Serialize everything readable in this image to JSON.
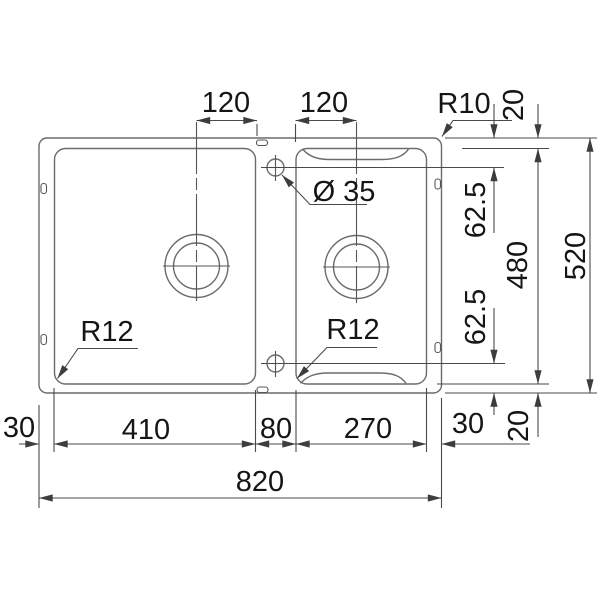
{
  "drawing": {
    "description": "Technical top-view dimension drawing of a one-and-a-half bowl kitchen sink",
    "background": "#ffffff",
    "line_color": "#6b6b6b",
    "dimension_line_color": "#4a4a4a",
    "text_color": "#151515"
  },
  "labels": {
    "top_offset_left_bowl": "120",
    "top_offset_right_bowl": "120",
    "outer_corner_radius": "R10",
    "rim_top": "20",
    "tap_hole_diameter": "Ø 35",
    "hole_offset_top": "62.5",
    "inner_height": "480",
    "overall_height": "520",
    "hole_offset_bottom": "62.5",
    "left_bowl_corner_radius": "R12",
    "right_bowl_corner_radius": "R12",
    "edge_left": "30",
    "left_bowl_width": "410",
    "divider_width": "80",
    "right_bowl_width": "270",
    "edge_right": "30",
    "rim_bottom": "20",
    "overall_width": "820"
  }
}
